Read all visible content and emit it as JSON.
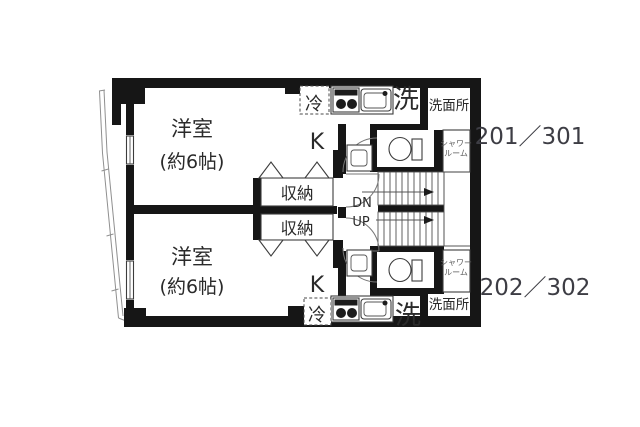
{
  "floorplan": {
    "units": [
      {
        "number": "201／301",
        "room_label": "洋室",
        "room_size": "(約6帖)",
        "kitchen_label": "K",
        "fridge_label": "冷",
        "laundry_label": "洗",
        "washroom_label": "洗面所",
        "shower_line1": "シャワー",
        "shower_line2": "ルーム",
        "storage_label": "収納"
      },
      {
        "number": "202／302",
        "room_label": "洋室",
        "room_size": "(約6帖)",
        "kitchen_label": "K",
        "fridge_label": "冷",
        "laundry_label": "洗",
        "washroom_label": "洗面所",
        "shower_line1": "シャワー",
        "shower_line2": "ルーム",
        "storage_label": "収納"
      }
    ],
    "stairs": {
      "down_label": "DN",
      "up_label": "UP"
    },
    "colors": {
      "wall": "#161616",
      "background": "#ffffff",
      "text": "#2a2a2a",
      "unit_number_text": "#3d3d44"
    }
  }
}
